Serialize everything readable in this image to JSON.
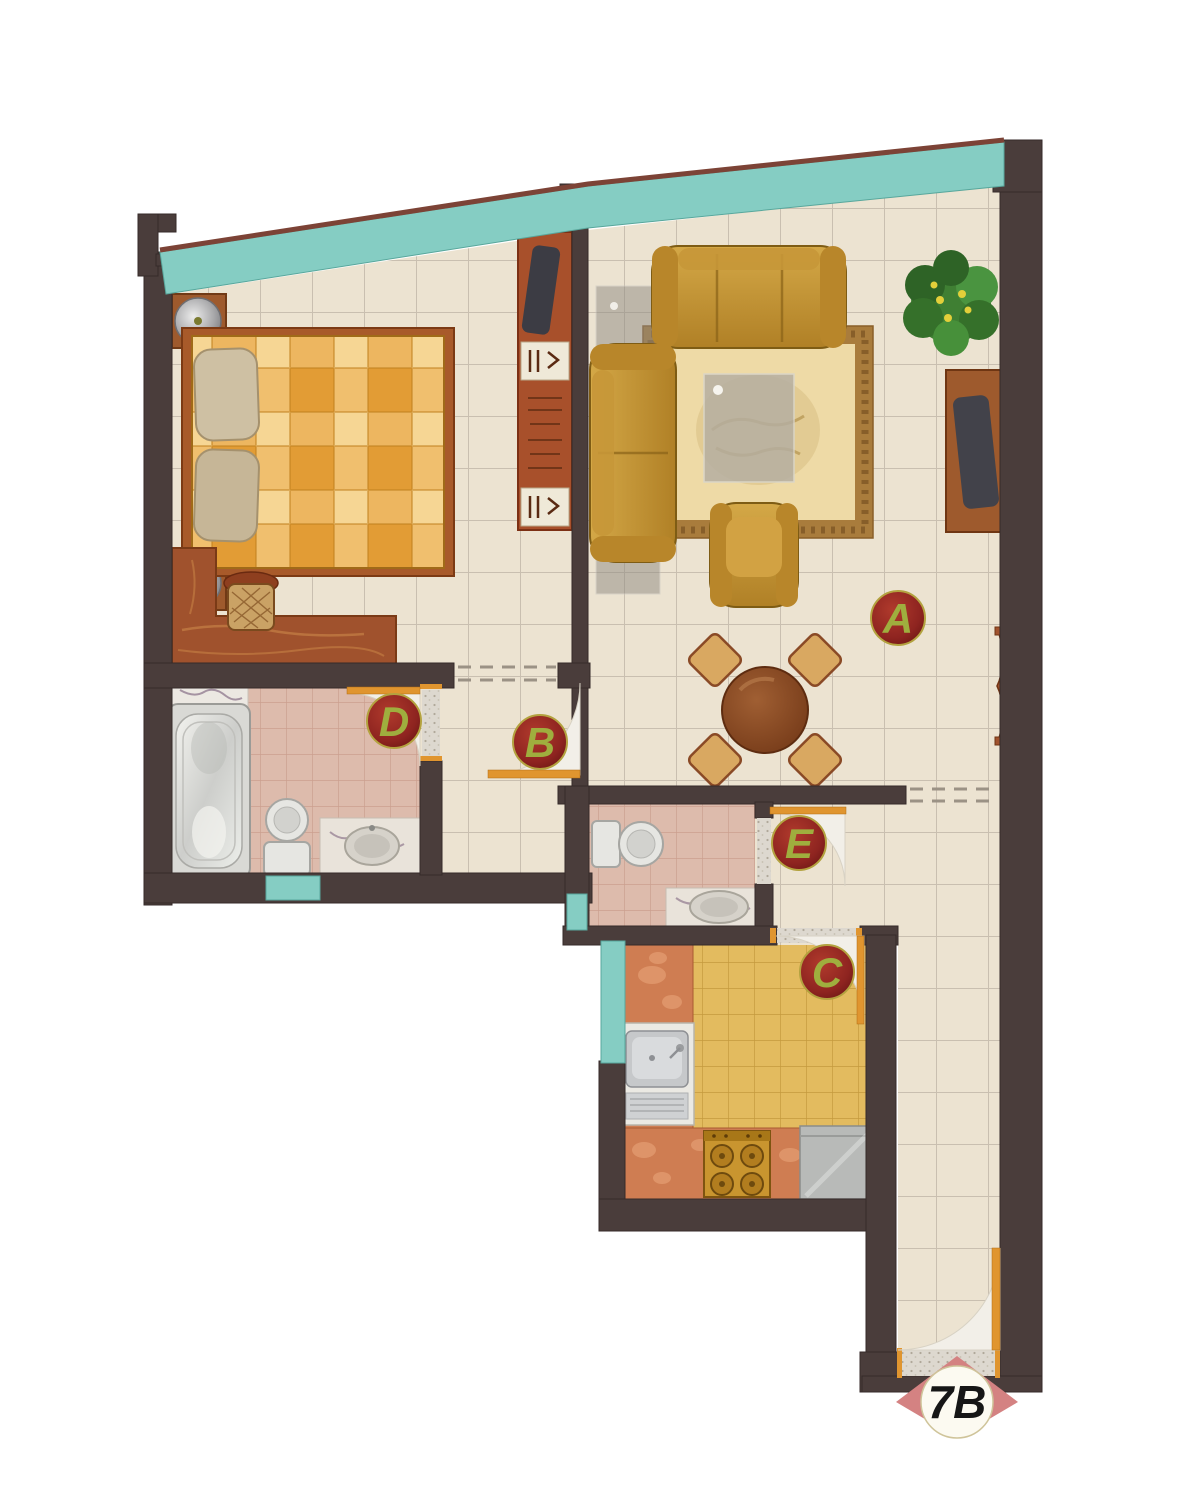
{
  "unit_badge": {
    "label": "7B"
  },
  "room_labels": {
    "living": "A",
    "bedroom": "B",
    "kitchen": "C",
    "bathroom_main": "D",
    "bathroom_small": "E"
  },
  "palette": {
    "wall": "#4a3d3b",
    "window_glass": "#85cdc3",
    "floor_main": "#ece3d1",
    "floor_bathroom": "#ddbbac",
    "floor_kitchen": "#e3bb5f",
    "door": "#e0952f",
    "label_circle": "#8e2420",
    "label_letter": "#9fae3e",
    "sofa": "#c89a3a",
    "wood": "#9e5a2d",
    "badge_triangle": "#d48282"
  }
}
